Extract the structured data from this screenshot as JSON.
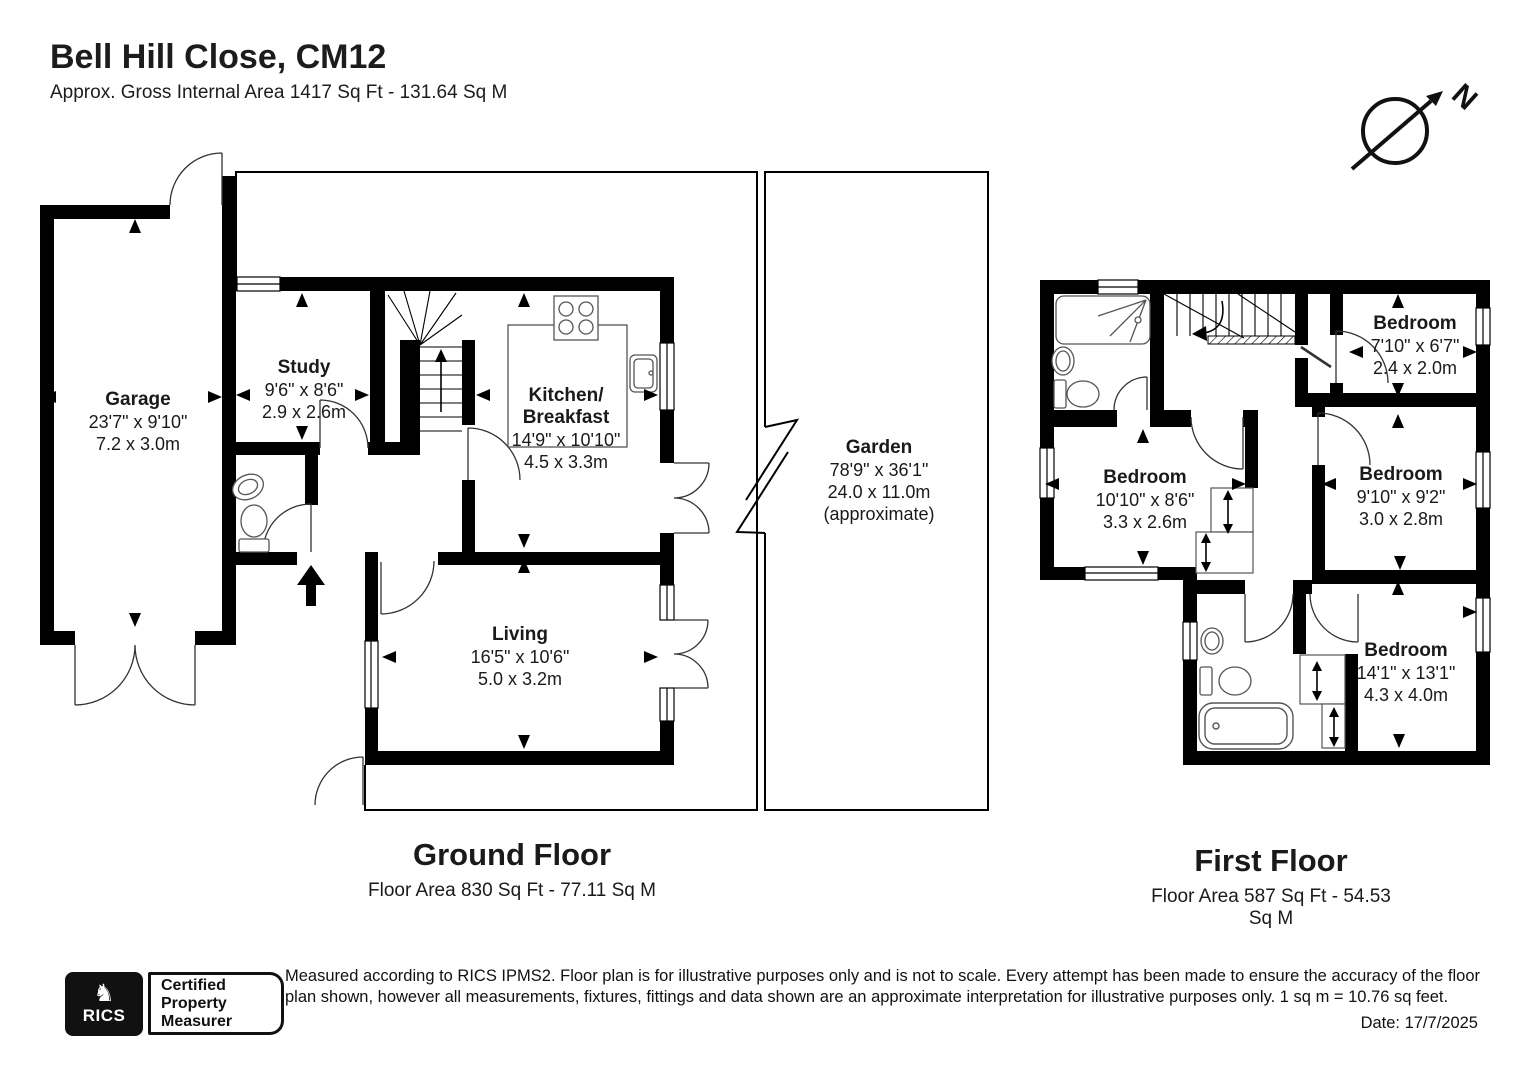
{
  "header": {
    "title": "Bell Hill Close, CM12",
    "subtitle": "Approx. Gross Internal Area 1417 Sq Ft - 131.64 Sq M"
  },
  "compass": {
    "north_label": "N"
  },
  "ground_floor": {
    "title": "Ground Floor",
    "area_line": "Floor Area 830 Sq Ft - 77.11 Sq M",
    "rooms": {
      "garage": {
        "name": "Garage",
        "imperial": "23'7\" x 9'10\"",
        "metric": "7.2 x 3.0m"
      },
      "study": {
        "name": "Study",
        "imperial": "9'6\" x 8'6\"",
        "metric": "2.9 x 2.6m"
      },
      "kitchen": {
        "name_line1": "Kitchen/",
        "name_line2": "Breakfast",
        "imperial": "14'9\" x 10'10\"",
        "metric": "4.5 x 3.3m"
      },
      "living": {
        "name": "Living",
        "imperial": "16'5\" x 10'6\"",
        "metric": "5.0 x 3.2m"
      },
      "garden": {
        "name": "Garden",
        "imperial": "78'9\" x 36'1\"",
        "metric": "24.0 x 11.0m",
        "note": "(approximate)"
      }
    }
  },
  "first_floor": {
    "title": "First Floor",
    "area_line": "Floor Area 587 Sq Ft - 54.53 Sq M",
    "rooms": {
      "bedroom_top_right": {
        "name": "Bedroom",
        "imperial": "7'10\" x 6'7\"",
        "metric": "2.4 x 2.0m"
      },
      "bedroom_left": {
        "name": "Bedroom",
        "imperial": "10'10\" x 8'6\"",
        "metric": "3.3 x 2.6m"
      },
      "bedroom_mid_right": {
        "name": "Bedroom",
        "imperial": "9'10\" x 9'2\"",
        "metric": "3.0 x 2.8m"
      },
      "bedroom_bottom": {
        "name": "Bedroom",
        "imperial": "14'1\" x 13'1\"",
        "metric": "4.3 x 4.0m"
      }
    }
  },
  "footer": {
    "rics_logo_text": "RICS",
    "badge_line1": "Certified",
    "badge_line2": "Property",
    "badge_line3": "Measurer",
    "disclaimer": "Measured according to RICS IPMS2. Floor plan is for illustrative purposes only and is not to scale. Every attempt has been made to ensure the accuracy of the floor plan shown, however all measurements, fixtures, fittings and data shown are an approximate interpretation for illustrative purposes only. 1 sq m = 10.76 sq feet.",
    "date": "Date: 17/7/2025"
  },
  "colors": {
    "walls": "#000000",
    "text": "#1a1a1a"
  }
}
